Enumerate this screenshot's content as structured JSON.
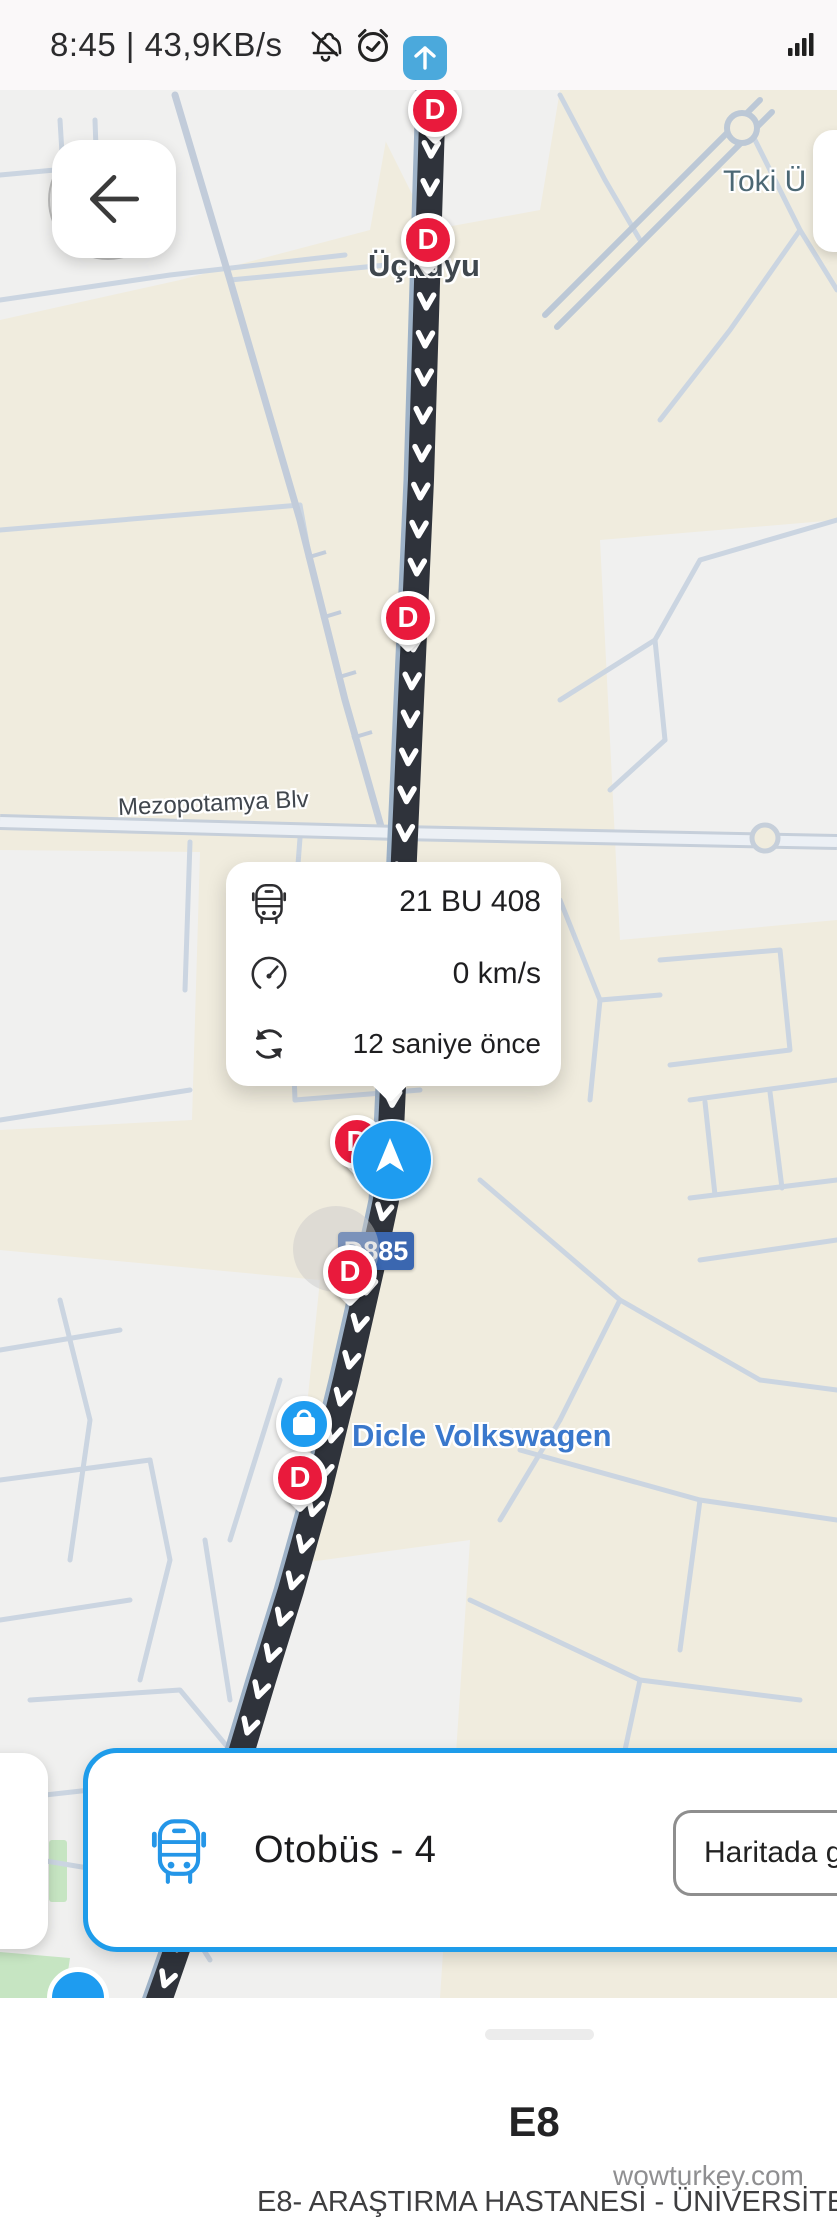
{
  "status_bar": {
    "time_and_speed": "8:45 | 43,9KB/s"
  },
  "map": {
    "labels": {
      "uckuyu": "Üçkuyu",
      "toki": "Toki Ü",
      "mezopotamya": "Mezopotamya Blv",
      "dicle": "Dicle Volkswagen"
    },
    "road_sign": "D885",
    "stop_letter": "D"
  },
  "info_card": {
    "plate": "21 BU 408",
    "speed": "0 km/s",
    "updated": "12 saniye önce"
  },
  "bottom_card": {
    "title": "Otobüs - 4",
    "map_button": "Haritada göster"
  },
  "bottom_sheet": {
    "route_code": "E8",
    "watermark": "wowturkey.com",
    "route_name": "E8- ARAŞTIRMA HASTANESİ - ÜNİVERSİTE"
  },
  "colors": {
    "accent_blue": "#1E9CEA",
    "marker_red": "#E91A3C",
    "route_black": "#2F333B",
    "sign_blue": "#3B67B0"
  }
}
